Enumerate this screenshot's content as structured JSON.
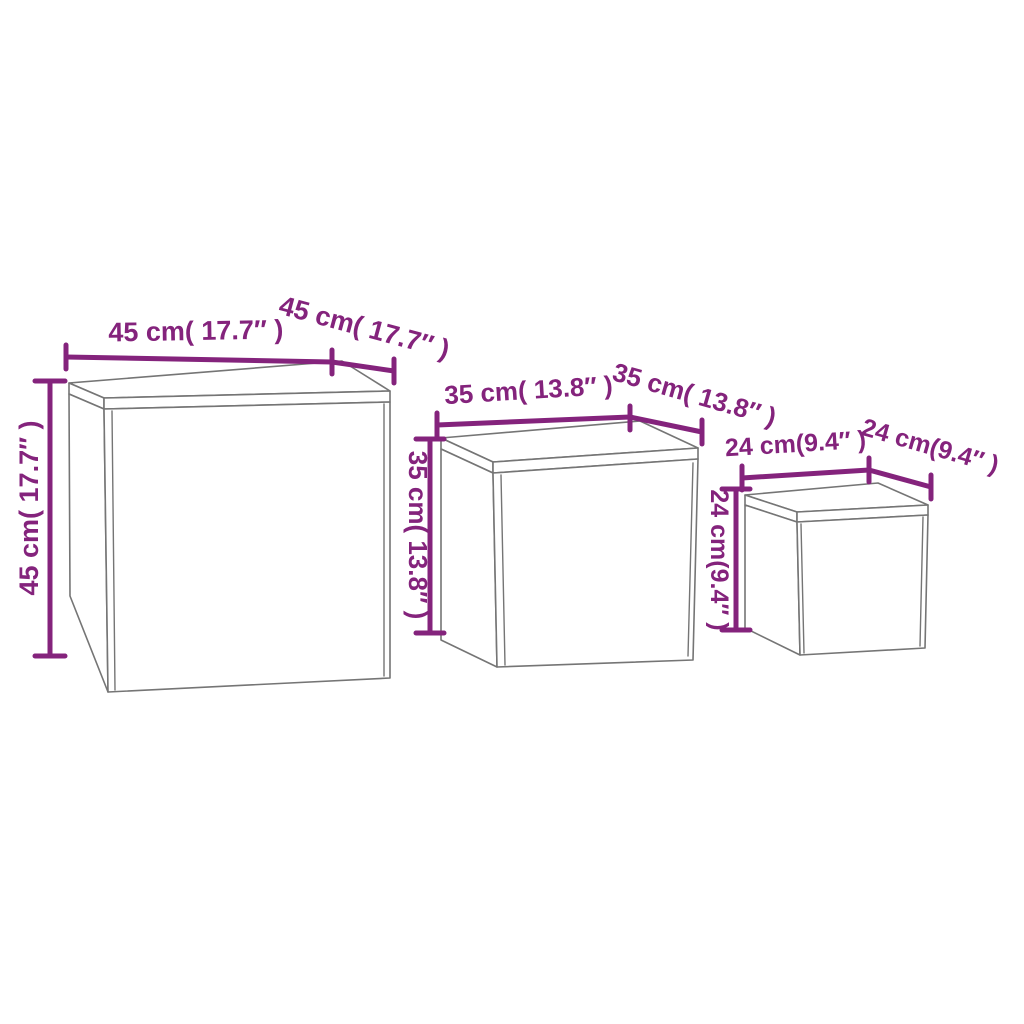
{
  "diagram": {
    "colors": {
      "dimension_purple": "#84237C",
      "box_outline_gray": "#757575",
      "background": "#FFFFFF"
    },
    "tables": [
      {
        "name": "large-table",
        "width_label": "45 cm( 17.7″ )",
        "depth_label": "45 cm( 17.7″ )",
        "height_label": "45 cm( 17.7″ )"
      },
      {
        "name": "medium-table",
        "width_label": "35 cm( 13.8″ )",
        "depth_label": "35 cm( 13.8″ )",
        "height_label": "35 cm( 13.8″ )"
      },
      {
        "name": "small-table",
        "width_label": "24 cm(9.4″ )",
        "depth_label": "24 cm(9.4″ )",
        "height_label": "24 cm(9.4″ )"
      }
    ]
  }
}
